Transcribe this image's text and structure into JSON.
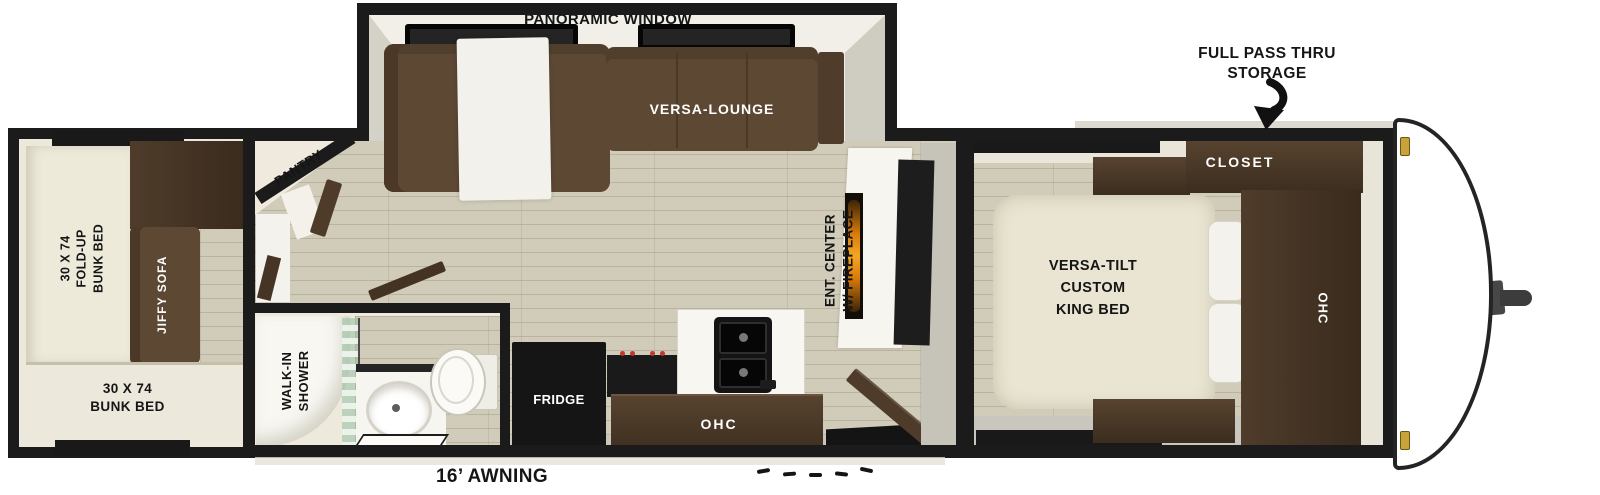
{
  "title": "Travel trailer floor plan",
  "exterior": {
    "storage_lines": [
      "FULL PASS THRU",
      "STORAGE"
    ],
    "awning_label": "16’ AWNING"
  },
  "slideout": {
    "window_label": "PANORAMIC WINDOW",
    "lounge_label": "VERSA-LOUNGE"
  },
  "living": {
    "pantry_label": "PANTRY",
    "ent_center_lines": [
      "ENT. CENTER",
      "W/ FIREPLACE"
    ]
  },
  "kitchen": {
    "fridge_label": "FRIDGE",
    "ohc_label": "OHC"
  },
  "bath": {
    "shower_lines": [
      "WALK-IN",
      "SHOWER"
    ]
  },
  "bedroom": {
    "bed_lines": [
      "VERSA-TILT",
      "CUSTOM",
      "KING BED"
    ],
    "closet_label": "CLOSET",
    "ohc_label": "OHC"
  },
  "rear_room": {
    "fold_up_bunk_lines": [
      "30 X 74",
      "FOLD-UP",
      "BUNK BED"
    ],
    "jiffy_sofa_label": "JIFFY SOFA",
    "bunk_bed_lines": [
      "30 X 74",
      "BUNK BED"
    ]
  },
  "colors": {
    "wall": "#1b1b1b",
    "floor_wood": "#d1ccb9",
    "cabinet_walnut": "#46362a",
    "sofa_brown": "#5d4834",
    "bed_cream": "#e9e5d2",
    "fireplace_flame": "#e8920f",
    "clearance_marker_gold": "#caa23a"
  }
}
